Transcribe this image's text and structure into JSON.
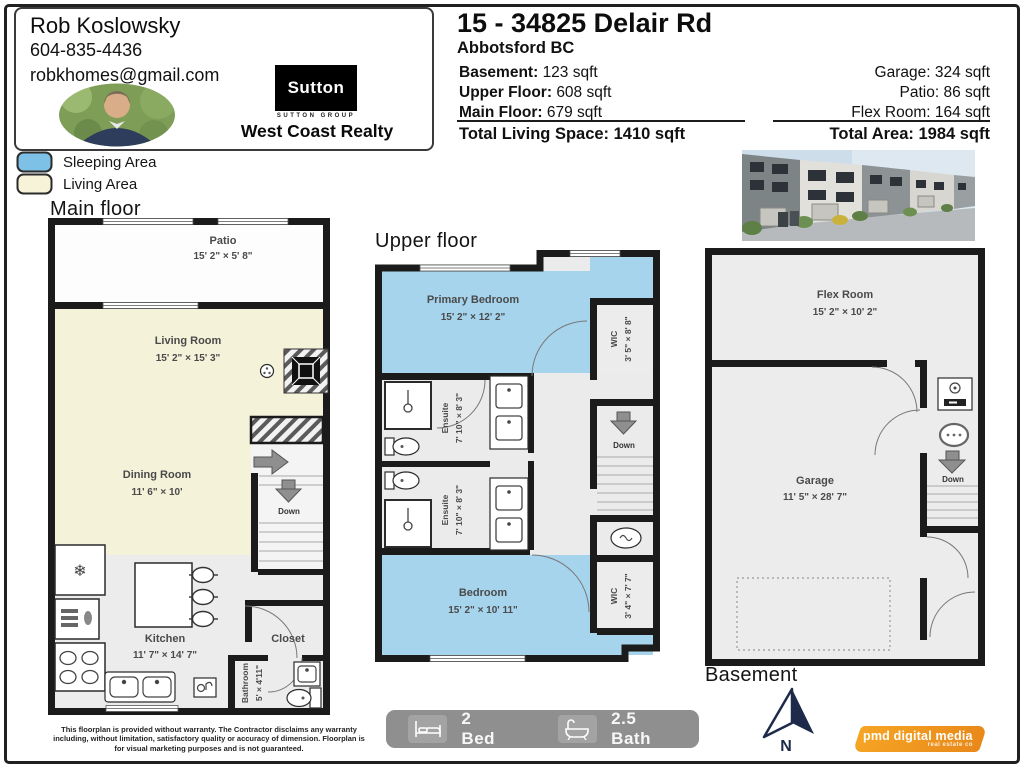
{
  "agent": {
    "name": "Rob Koslowsky",
    "phone": "604-835-4436",
    "email": "robkhomes@gmail.com",
    "brokerage": {
      "logo_text": "Sutton",
      "group_text": "SUTTON GROUP",
      "name": "West Coast Realty"
    }
  },
  "listing": {
    "address": "15 - 34825 Delair Rd",
    "city": "Abbotsford BC",
    "area_left": [
      {
        "label": "Basement:",
        "value": "123 sqft"
      },
      {
        "label": "Upper Floor:",
        "value": "608 sqft"
      },
      {
        "label": "Main Floor:",
        "value": "679 sqft"
      }
    ],
    "area_right": [
      {
        "text": "Garage: 324 sqft"
      },
      {
        "text": "Patio: 86 sqft"
      },
      {
        "text": "Flex Room: 164 sqft"
      }
    ],
    "total_living": "Total Living Space: 1410 sqft",
    "total_area": "Total Area: 1984 sqft"
  },
  "legend": {
    "sleeping": {
      "label": "Sleeping Area",
      "color": "#7dc2e6"
    },
    "living": {
      "label": "Living Area",
      "color": "#f6f3d8"
    }
  },
  "floors": {
    "main": {
      "title": "Main floor",
      "patio": {
        "name": "Patio",
        "dims": "15' 2\" × 5' 8\""
      },
      "living": {
        "name": "Living Room",
        "dims": "15' 2\" × 15' 3\""
      },
      "dining": {
        "name": "Dining Room",
        "dims": "11' 6\" × 10'"
      },
      "kitchen": {
        "name": "Kitchen",
        "dims": "11' 7\" × 14' 7\""
      },
      "closet": {
        "name": "Closet"
      },
      "bathroom": {
        "name": "Bathroom",
        "dims": "5' × 4'11\""
      },
      "stairs_down": "Down"
    },
    "upper": {
      "title": "Upper floor",
      "primary": {
        "name": "Primary Bedroom",
        "dims": "15' 2\" × 12' 2\""
      },
      "wic1": {
        "name": "WIC",
        "dims": "3' 5\" × 8' 8\""
      },
      "ensuite1": {
        "name": "Ensuite",
        "dims": "7' 10\" × 8' 3\""
      },
      "ensuite2": {
        "name": "Ensuite",
        "dims": "7' 10\" × 8' 3\""
      },
      "bedroom": {
        "name": "Bedroom",
        "dims": "15' 2\" × 10' 11\""
      },
      "wic2": {
        "name": "WIC",
        "dims": "3' 4\" × 7' 7\""
      },
      "stairs_down": "Down"
    },
    "basement": {
      "title": "Basement",
      "flex": {
        "name": "Flex Room",
        "dims": "15' 2\" × 10' 2\""
      },
      "garage": {
        "name": "Garage",
        "dims": "11' 5\" × 28' 7\""
      },
      "stairs_down": "Down"
    }
  },
  "footer": {
    "beds": "2 Bed",
    "baths": "2.5 Bath",
    "disclaimer_lines": [
      "This floorplan is provided without warranty. The Contractor disclaims any warranty",
      "including, without limitation, satisfactory quality or accuracy of dimension. Floorplan is",
      "for visual marketing purposes and is not guaranteed."
    ],
    "compass": "N",
    "credit": "pmd digital media",
    "credit_sub": "real estate co"
  }
}
